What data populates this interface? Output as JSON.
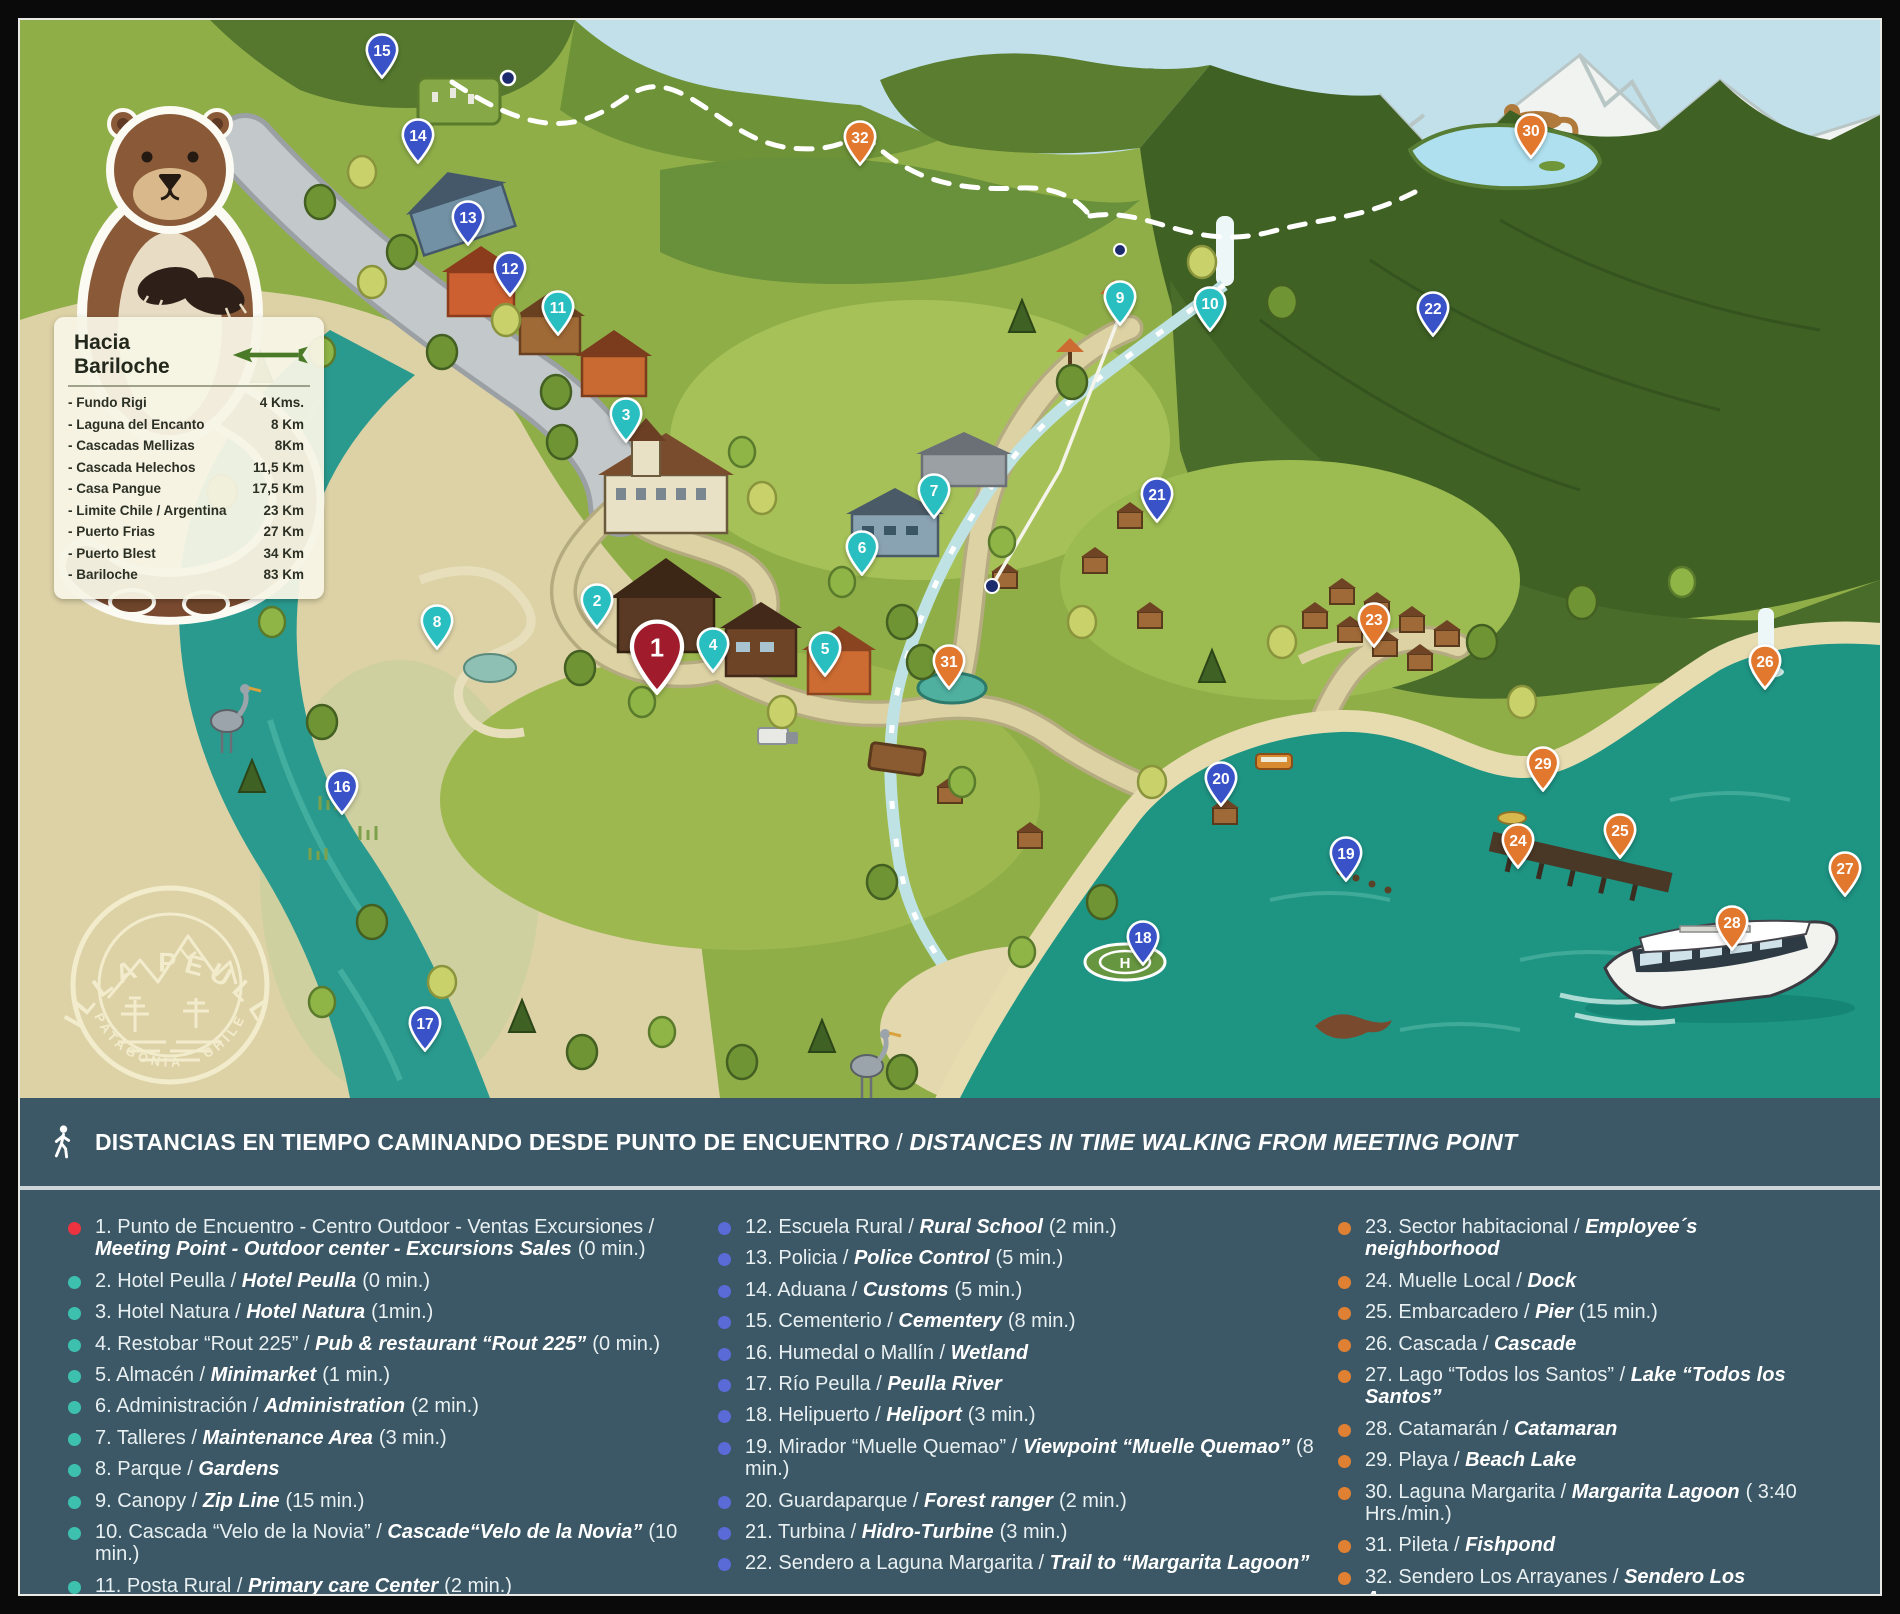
{
  "branding": {
    "logo_title": "VILLA PEULLA",
    "logo_subtitle": "PATAGONIA · CHILE"
  },
  "info_box": {
    "title": "Hacia Bariloche",
    "items": [
      {
        "name": "- Fundo Rigi",
        "distance": "4 Kms."
      },
      {
        "name": "- Laguna del Encanto",
        "distance": "8 Km"
      },
      {
        "name": "- Cascadas Mellizas",
        "distance": "8Km"
      },
      {
        "name": "- Cascada Helechos",
        "distance": "11,5 Km"
      },
      {
        "name": "- Casa Pangue",
        "distance": "17,5 Km"
      },
      {
        "name": "- Limite Chile / Argentina",
        "distance": "23 Km"
      },
      {
        "name": "- Puerto Frias",
        "distance": "27 Km"
      },
      {
        "name": "- Puerto Blest",
        "distance": "34 Km"
      },
      {
        "name": "- Bariloche",
        "distance": "83 Km"
      }
    ]
  },
  "footer_bar": {
    "icon": "walking-person-icon",
    "es": "DISTANCIAS EN TIEMPO CAMINANDO DESDE PUNTO DE ENCUENTRO",
    "sep": " / ",
    "en": "DISTANCES IN TIME WALKING FROM MEETING POINT"
  },
  "colors": {
    "panel": "#3c5866",
    "pins": {
      "red": "#a01b2b",
      "teal": "#29bec0",
      "blue": "#3952c8",
      "orange": "#e2782e"
    },
    "bullets": {
      "red": "#ee3340",
      "teal": "#3ec0ae",
      "blue": "#5a6ad6",
      "orange": "#e08032"
    },
    "lake": "#1e9483",
    "river": "#2a9a8e"
  },
  "legend": {
    "items": [
      {
        "num": 1,
        "es": "Punto de Encuentro - Centro Outdoor - Ventas Excursiones",
        "en": "Meeting Point - Outdoor center  - Excursions Sales",
        "time": "(0 min.)",
        "color": "red"
      },
      {
        "num": 2,
        "es": "Hotel Peulla",
        "en": "Hotel Peulla",
        "time": "(0 min.)",
        "color": "teal"
      },
      {
        "num": 3,
        "es": "Hotel Natura",
        "en": "Hotel Natura",
        "time": "(1min.)",
        "color": "teal"
      },
      {
        "num": 4,
        "es": "Restobar “Rout 225”",
        "en": "Pub & restaurant “Rout 225”",
        "time": "(0 min.)",
        "color": "teal"
      },
      {
        "num": 5,
        "es": "Almacén",
        "en": "Minimarket",
        "time": "(1 min.)",
        "color": "teal"
      },
      {
        "num": 6,
        "es": "Administración",
        "en": "Administration",
        "time": "(2 min.)",
        "color": "teal"
      },
      {
        "num": 7,
        "es": "Talleres",
        "en": "Maintenance Area",
        "time": "(3 min.)",
        "color": "teal"
      },
      {
        "num": 8,
        "es": "Parque",
        "en": "Gardens",
        "time": "",
        "color": "teal"
      },
      {
        "num": 9,
        "es": "Canopy",
        "en": "Zip Line",
        "time": "(15 min.)",
        "color": "teal"
      },
      {
        "num": 10,
        "es": "Cascada “Velo de la Novia”",
        "en": "Cascade“Velo de la Novia”",
        "time": "(10 min.)",
        "color": "teal"
      },
      {
        "num": 11,
        "es": "Posta Rural",
        "en": "Primary care Center",
        "time": "(2 min.)",
        "color": "teal"
      },
      {
        "num": 12,
        "es": "Escuela Rural",
        "en": "Rural School",
        "time": "(2 min.)",
        "color": "blue"
      },
      {
        "num": 13,
        "es": "Policia",
        "en": "Police Control",
        "time": "(5 min.)",
        "color": "blue"
      },
      {
        "num": 14,
        "es": "Aduana",
        "en": "Customs",
        "time": "(5 min.)",
        "color": "blue"
      },
      {
        "num": 15,
        "es": "Cementerio",
        "en": "Cementery",
        "time": "(8 min.)",
        "color": "blue"
      },
      {
        "num": 16,
        "es": "Humedal o Mallín",
        "en": "Wetland",
        "time": "",
        "color": "blue"
      },
      {
        "num": 17,
        "es": "Río Peulla",
        "en": "Peulla River",
        "time": "",
        "color": "blue"
      },
      {
        "num": 18,
        "es": "Helipuerto",
        "en": "Heliport",
        "time": "(3 min.)",
        "color": "blue"
      },
      {
        "num": 19,
        "es": "Mirador “Muelle Quemao”",
        "en": "Viewpoint “Muelle Quemao”",
        "time": "(8 min.)",
        "color": "blue"
      },
      {
        "num": 20,
        "es": "Guardaparque",
        "en": "Forest ranger",
        "time": "(2 min.)",
        "color": "blue"
      },
      {
        "num": 21,
        "es": "Turbina",
        "en": "Hidro-Turbine",
        "time": "(3 min.)",
        "color": "blue"
      },
      {
        "num": 22,
        "es": "Sendero a Laguna Margarita",
        "en": "Trail to “Margarita Lagoon”",
        "time": "",
        "color": "blue"
      },
      {
        "num": 23,
        "es": "Sector habitacional",
        "en": "Employee´s neighborhood",
        "time": "",
        "color": "orange"
      },
      {
        "num": 24,
        "es": "Muelle Local",
        "en": "Dock",
        "time": "",
        "color": "orange"
      },
      {
        "num": 25,
        "es": "Embarcadero",
        "en": "Pier",
        "time": "(15 min.)",
        "color": "orange"
      },
      {
        "num": 26,
        "es": "Cascada",
        "en": "Cascade",
        "time": "",
        "color": "orange"
      },
      {
        "num": 27,
        "es": "Lago “Todos los Santos”",
        "en": "Lake “Todos los Santos”",
        "time": "",
        "color": "orange"
      },
      {
        "num": 28,
        "es": "Catamarán",
        "en": "Catamaran",
        "time": "",
        "color": "orange"
      },
      {
        "num": 29,
        "es": "Playa",
        "en": "Beach Lake",
        "time": "",
        "color": "orange"
      },
      {
        "num": 30,
        "es": "Laguna Margarita",
        "en": "Margarita Lagoon",
        "time": "( 3:40 Hrs./min.)",
        "color": "orange"
      },
      {
        "num": 31,
        "es": "Pileta",
        "en": "Fishpond",
        "time": "",
        "color": "orange"
      },
      {
        "num": 32,
        "es": "Sendero Los Arrayanes",
        "en": "Sendero Los Ayarranes",
        "time": "",
        "color": "orange"
      }
    ]
  },
  "map": {
    "markers": [
      {
        "number": 1,
        "x": 637,
        "y": 627,
        "color": "red",
        "large": true
      },
      {
        "number": 2,
        "x": 577,
        "y": 580,
        "color": "teal"
      },
      {
        "number": 3,
        "x": 606,
        "y": 394,
        "color": "teal"
      },
      {
        "number": 4,
        "x": 693,
        "y": 624,
        "color": "teal"
      },
      {
        "number": 5,
        "x": 805,
        "y": 628,
        "color": "teal"
      },
      {
        "number": 6,
        "x": 842,
        "y": 527,
        "color": "teal"
      },
      {
        "number": 7,
        "x": 914,
        "y": 470,
        "color": "teal"
      },
      {
        "number": 8,
        "x": 417,
        "y": 601,
        "color": "teal"
      },
      {
        "number": 9,
        "x": 1100,
        "y": 277,
        "color": "teal"
      },
      {
        "number": 10,
        "x": 1190,
        "y": 283,
        "color": "teal"
      },
      {
        "number": 11,
        "x": 538,
        "y": 287,
        "color": "teal"
      },
      {
        "number": 12,
        "x": 490,
        "y": 248,
        "color": "blue"
      },
      {
        "number": 13,
        "x": 448,
        "y": 197,
        "color": "blue"
      },
      {
        "number": 14,
        "x": 398,
        "y": 115,
        "color": "blue"
      },
      {
        "number": 15,
        "x": 362,
        "y": 30,
        "color": "blue"
      },
      {
        "number": 16,
        "x": 322,
        "y": 766,
        "color": "blue"
      },
      {
        "number": 17,
        "x": 405,
        "y": 1003,
        "color": "blue"
      },
      {
        "number": 18,
        "x": 1123,
        "y": 917,
        "color": "blue"
      },
      {
        "number": 19,
        "x": 1326,
        "y": 833,
        "color": "blue"
      },
      {
        "number": 20,
        "x": 1201,
        "y": 758,
        "color": "blue"
      },
      {
        "number": 21,
        "x": 1137,
        "y": 474,
        "color": "blue"
      },
      {
        "number": 22,
        "x": 1413,
        "y": 288,
        "color": "blue"
      },
      {
        "number": 23,
        "x": 1354,
        "y": 599,
        "color": "orange"
      },
      {
        "number": 24,
        "x": 1498,
        "y": 820,
        "color": "orange"
      },
      {
        "number": 25,
        "x": 1600,
        "y": 810,
        "color": "orange"
      },
      {
        "number": 26,
        "x": 1745,
        "y": 641,
        "color": "orange"
      },
      {
        "number": 27,
        "x": 1825,
        "y": 848,
        "color": "orange"
      },
      {
        "number": 28,
        "x": 1712,
        "y": 902,
        "color": "orange"
      },
      {
        "number": 29,
        "x": 1523,
        "y": 743,
        "color": "orange"
      },
      {
        "number": 30,
        "x": 1511,
        "y": 110,
        "color": "orange"
      },
      {
        "number": 31,
        "x": 929,
        "y": 641,
        "color": "orange"
      },
      {
        "number": 32,
        "x": 840,
        "y": 117,
        "color": "orange"
      }
    ]
  }
}
